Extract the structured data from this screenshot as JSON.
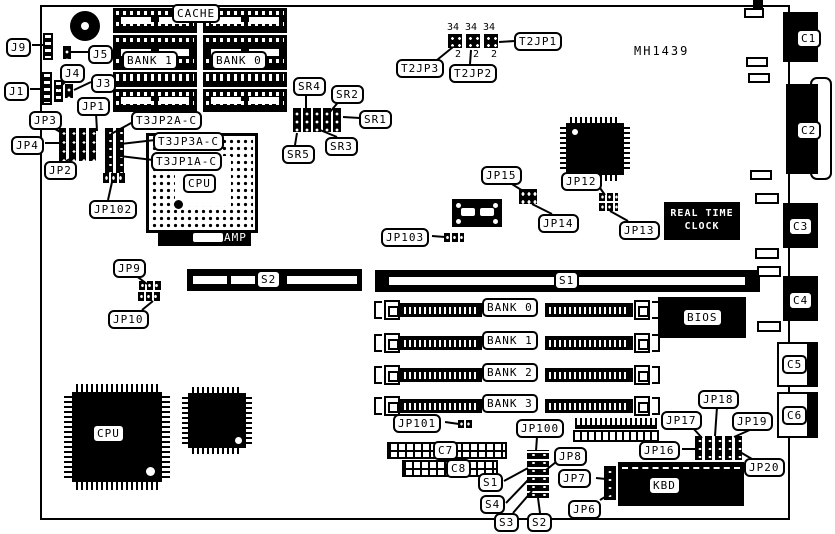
{
  "board": {
    "part_number": "MH1439"
  },
  "callouts": {
    "j9": "J9",
    "j5": "J5",
    "j4": "J4",
    "j1": "J1",
    "j3": "J3",
    "jp1": "JP1",
    "jp2": "JP2",
    "jp3": "JP3",
    "jp4": "JP4",
    "jp102": "JP102",
    "t3jp2ac": "T3JP2A-C",
    "t3jp3ac": "T3JP3A-C",
    "t3jp1ac": "T3JP1A-C",
    "sr1": "SR1",
    "sr2": "SR2",
    "sr3": "SR3",
    "sr4": "SR4",
    "sr5": "SR5",
    "t2jp1": "T2JP1",
    "t2jp2": "T2JP2",
    "t2jp3": "T2JP3",
    "jp12": "JP12",
    "jp13": "JP13",
    "jp14": "JP14",
    "jp15": "JP15",
    "jp103": "JP103",
    "jp9": "JP9",
    "jp10": "JP10",
    "jp101": "JP101",
    "jp100": "JP100",
    "s1": "S1",
    "s2": "S2",
    "s3": "S3",
    "s4": "S4",
    "jp6": "JP6",
    "jp7": "JP7",
    "jp8": "JP8",
    "jp16": "JP16",
    "jp17": "JP17",
    "jp18": "JP18",
    "jp19": "JP19",
    "jp20": "JP20"
  },
  "components": {
    "cache": "CACHE",
    "bank1_dip": "BANK 1",
    "bank0_dip": "BANK 0",
    "cpu_socket": "CPU",
    "amp": "AMP",
    "cpu_chip": "CPU",
    "rtc_line1": "REAL TIME",
    "rtc_line2": "CLOCK",
    "bios": "BIOS",
    "kbd": "KBD",
    "slot_s1": "S1",
    "slot_s2": "S2",
    "simm_banks": [
      "BANK 0",
      "BANK 1",
      "BANK 2",
      "BANK 3"
    ],
    "c1": "C1",
    "c2": "C2",
    "c3": "C3",
    "c4": "C4",
    "c5": "C5",
    "c6": "C6",
    "c7": "C7",
    "c8": "C8"
  },
  "pin_numbers": {
    "t2jp_top": [
      "34",
      "34",
      "34"
    ],
    "t2jp_bottom": [
      "2",
      "2",
      "2"
    ]
  }
}
